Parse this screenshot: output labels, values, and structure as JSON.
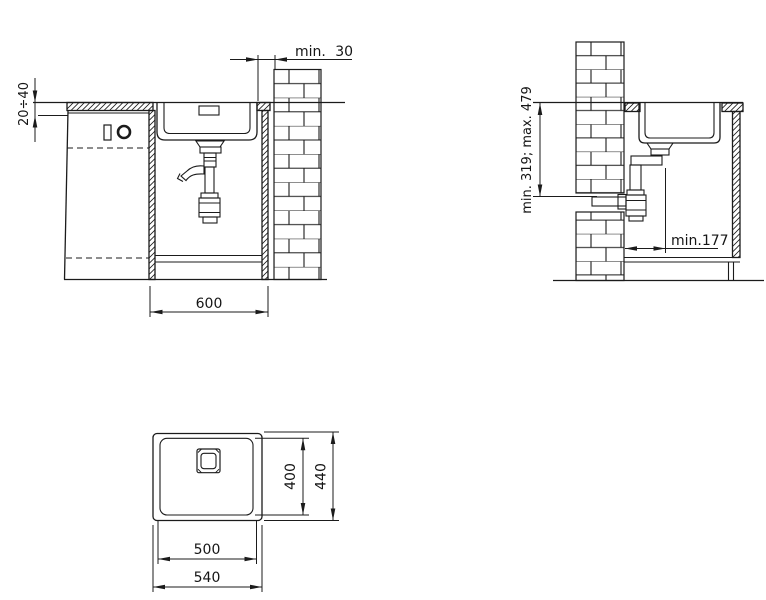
{
  "page": {
    "background": "#ffffff",
    "line_color": "#1b1b1b"
  },
  "front_view": {
    "wall_clearance": "min. 30",
    "worktop_thickness": "20÷40",
    "cabinet_width": "600"
  },
  "side_view": {
    "outlet_height": "min. 319; max. 479",
    "wall_to_drain": "min.177"
  },
  "top_view": {
    "bowl_depth": "400",
    "overall_depth": "440",
    "bowl_width": "500",
    "overall_width": "540"
  }
}
